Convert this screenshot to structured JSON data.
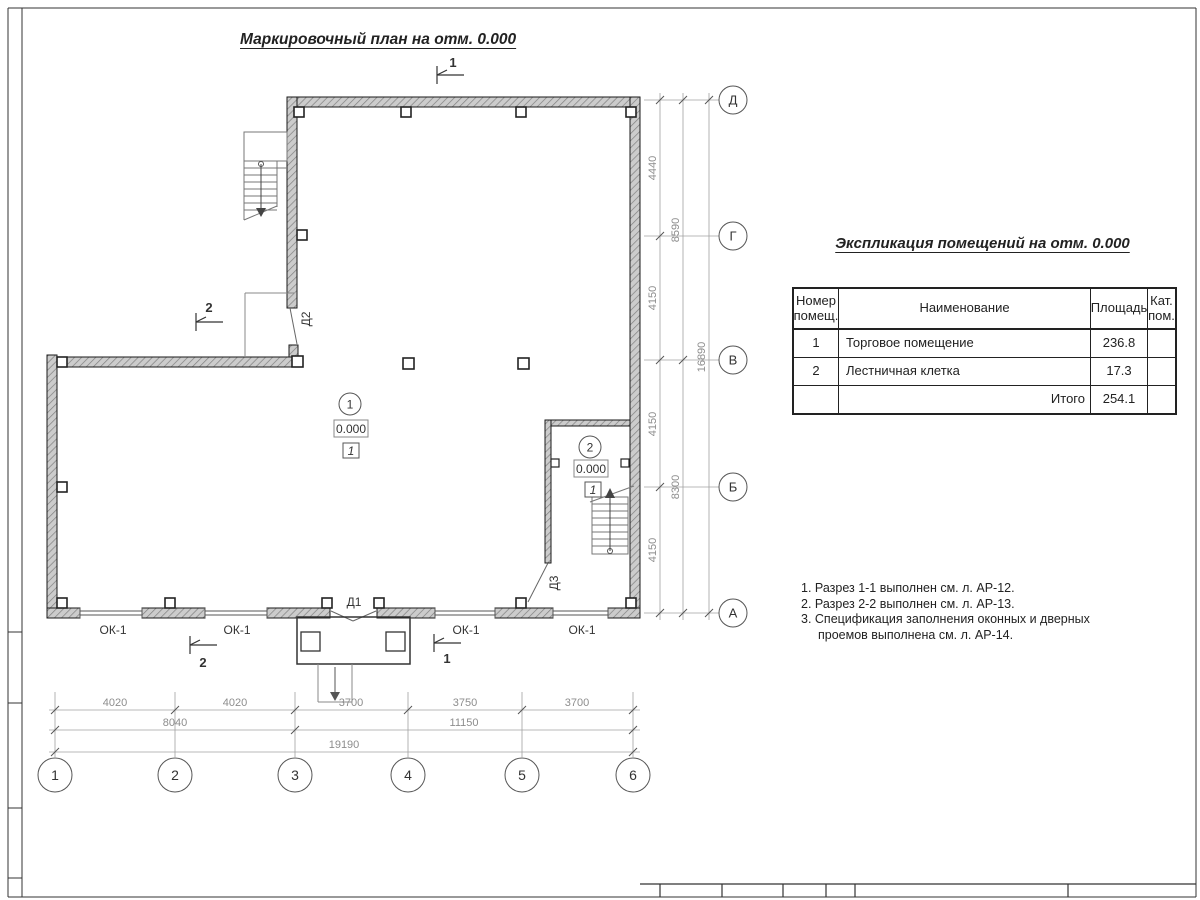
{
  "titles": {
    "main": "Маркировочный план на отм. 0.000",
    "table": "Экспликация помещений на отм. 0.000"
  },
  "table": {
    "header": {
      "col1a": "Номер",
      "col1b": "помещ.",
      "col2": "Наименование",
      "col3": "Площадь",
      "col4a": "Кат.",
      "col4b": "пом."
    },
    "rows": [
      {
        "num": "1",
        "name": "Торговое помещение",
        "area": "236.8",
        "cat": ""
      },
      {
        "num": "2",
        "name": "Лестничная клетка",
        "area": "17.3",
        "cat": ""
      }
    ],
    "total": {
      "label": "Итого",
      "area": "254.1"
    }
  },
  "notes": {
    "line1": "1. Разрез 1-1 выполнен см. л. АР-12.",
    "line2": "2. Разрез 2-2 выполнен см. л. АР-13.",
    "line3": "3. Спецификация заполнения оконных и дверных",
    "line4": "проемов выполнена см. л. АР-14."
  },
  "axes": {
    "row0": "Д",
    "row1": "Г",
    "row2": "В",
    "row3": "Б",
    "row4": "А",
    "col0": "1",
    "col1": "2",
    "col2": "3",
    "col3": "4",
    "col4": "5",
    "col5": "6"
  },
  "dims_right": {
    "s1": "4440",
    "s2": "4150",
    "s3": "4150",
    "s4": "4150",
    "m1": "8590",
    "m2": "8300",
    "total": "16890"
  },
  "dims_bottom": {
    "s1": "4020",
    "s2": "4020",
    "s3": "3700",
    "s4": "3750",
    "s5": "3700",
    "m1": "8040",
    "m2": "11150",
    "total": "19190"
  },
  "plan_labels": {
    "window": "ОК-1",
    "door1": "Д1",
    "door2": "Д2",
    "door3": "Д3",
    "room1_num": "1",
    "room2_num": "2",
    "room1_elev": "0.000",
    "room2_elev": "0.000",
    "room1_floor": "1",
    "room2_floor": "1",
    "section1": "1",
    "section2": "2"
  }
}
